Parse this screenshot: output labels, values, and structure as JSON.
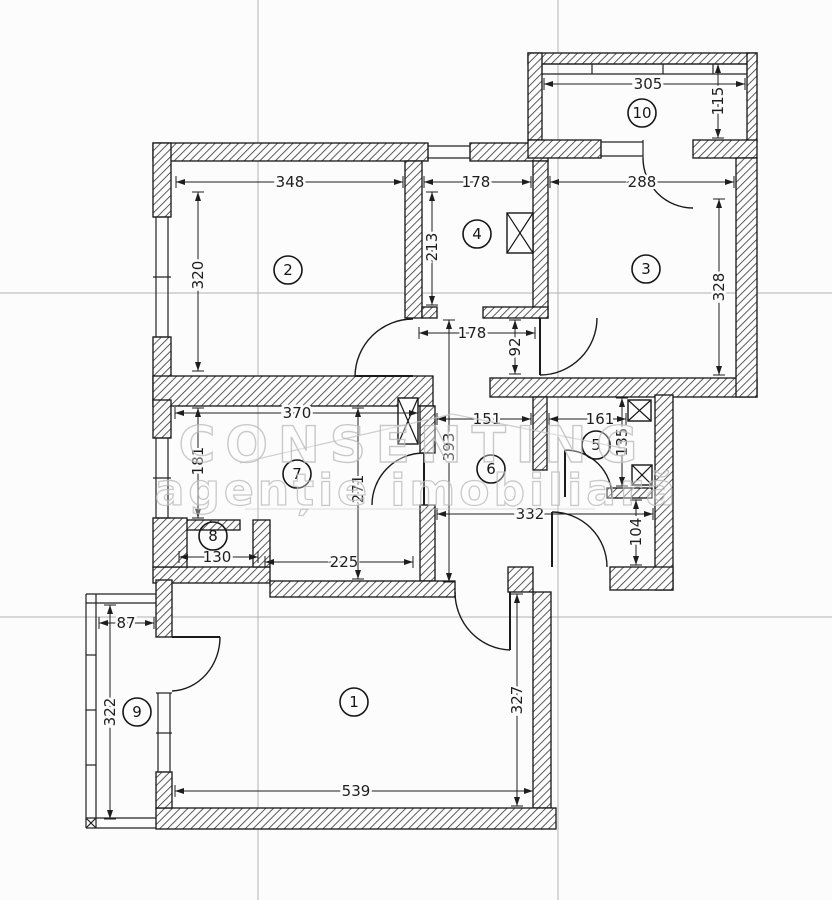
{
  "document": {
    "kind": "apartment floor plan drawing",
    "units": "cm"
  },
  "watermark": {
    "line1": "CONSENTING",
    "line2": "agenție imobiliară"
  },
  "colors": {
    "paper": "#fcfcfc",
    "wall_outline": "#151515",
    "hatch": "#3f3f3f",
    "grid_line": "#b2b2b2",
    "dim_text": "#1e1e1e",
    "watermark": "#bdbdbd"
  },
  "room_labels": [
    {
      "number": "1",
      "x": 354,
      "y": 702
    },
    {
      "number": "2",
      "x": 288,
      "y": 270
    },
    {
      "number": "3",
      "x": 646,
      "y": 269
    },
    {
      "number": "4",
      "x": 477,
      "y": 234
    },
    {
      "number": "5",
      "x": 596,
      "y": 445
    },
    {
      "number": "6",
      "x": 491,
      "y": 469
    },
    {
      "number": "7",
      "x": 297,
      "y": 474
    },
    {
      "number": "8",
      "x": 213,
      "y": 536
    },
    {
      "number": "9",
      "x": 137,
      "y": 712
    },
    {
      "number": "10",
      "x": 642,
      "y": 113
    }
  ],
  "dimensions_horizontal": [
    {
      "value": "348",
      "y": 182,
      "x1": 176,
      "x2": 403,
      "tx": 290
    },
    {
      "value": "178",
      "y": 182,
      "x1": 424,
      "x2": 531,
      "tx": 476
    },
    {
      "value": "305",
      "y": 84,
      "x1": 544,
      "x2": 745,
      "tx": 648
    },
    {
      "value": "288",
      "y": 182,
      "x1": 550,
      "x2": 734,
      "tx": 642
    },
    {
      "value": "178",
      "y": 333,
      "x1": 419,
      "x2": 535,
      "tx": 472
    },
    {
      "value": "370",
      "y": 413,
      "x1": 175,
      "x2": 418,
      "tx": 297
    },
    {
      "value": "151",
      "y": 419,
      "x1": 437,
      "x2": 531,
      "tx": 487
    },
    {
      "value": "161",
      "y": 419,
      "x1": 549,
      "x2": 626,
      "tx": 600
    },
    {
      "value": "332",
      "y": 514,
      "x1": 437,
      "x2": 653,
      "tx": 530
    },
    {
      "value": "130",
      "y": 557,
      "x1": 179,
      "x2": 258,
      "tx": 217
    },
    {
      "value": "225",
      "y": 562,
      "x1": 265,
      "x2": 413,
      "tx": 344
    },
    {
      "value": "87",
      "y": 623,
      "x1": 99,
      "x2": 154,
      "tx": 126
    },
    {
      "value": "539",
      "y": 791,
      "x1": 175,
      "x2": 533,
      "tx": 356
    }
  ],
  "dimensions_vertical": [
    {
      "value": "320",
      "x": 198,
      "y1": 192,
      "y2": 371,
      "ty": 275
    },
    {
      "value": "213",
      "x": 432,
      "y1": 192,
      "y2": 305,
      "ty": 247
    },
    {
      "value": "115",
      "x": 718,
      "y1": 64,
      "y2": 138,
      "ty": 101
    },
    {
      "value": "328",
      "x": 719,
      "y1": 199,
      "y2": 375,
      "ty": 287
    },
    {
      "value": "92",
      "x": 515,
      "y1": 320,
      "y2": 374,
      "ty": 347
    },
    {
      "value": "181",
      "x": 198,
      "y1": 408,
      "y2": 518,
      "ty": 461
    },
    {
      "value": "271",
      "x": 358,
      "y1": 408,
      "y2": 579,
      "ty": 489
    },
    {
      "value": "393",
      "x": 449,
      "y1": 320,
      "y2": 582,
      "ty": 447
    },
    {
      "value": "135",
      "x": 622,
      "y1": 398,
      "y2": 486,
      "ty": 442
    },
    {
      "value": "104",
      "x": 636,
      "y1": 500,
      "y2": 565,
      "ty": 532
    },
    {
      "value": "322",
      "x": 110,
      "y1": 605,
      "y2": 819,
      "ty": 712
    },
    {
      "value": "327",
      "x": 517,
      "y1": 594,
      "y2": 806,
      "ty": 700
    }
  ],
  "shaft_symbols": [
    {
      "x": 507,
      "y": 213,
      "w": 26,
      "h": 40
    },
    {
      "x": 398,
      "y": 398,
      "w": 20,
      "h": 46
    },
    {
      "x": 628,
      "y": 400,
      "w": 23,
      "h": 21
    },
    {
      "x": 632,
      "y": 465,
      "w": 20,
      "h": 20
    }
  ]
}
